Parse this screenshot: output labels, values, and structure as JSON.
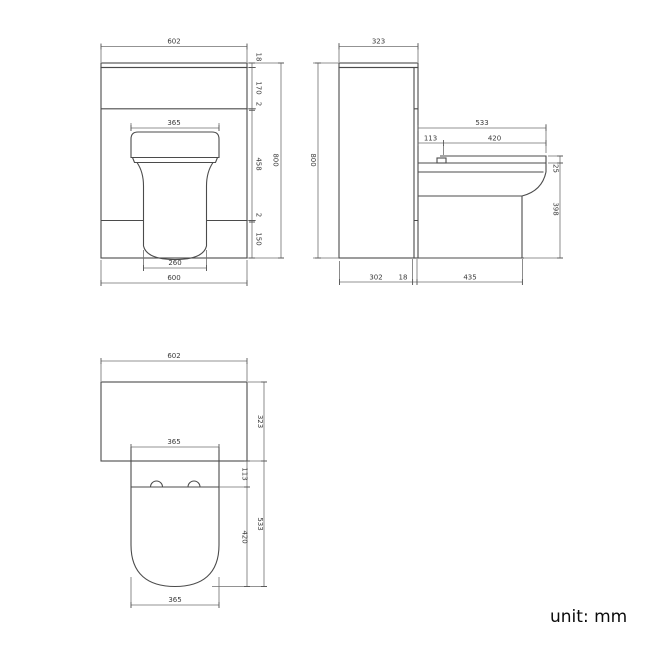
{
  "unit_note": "unit: mm",
  "colors": {
    "line": "#4b4b4b",
    "dimension_line": "#6f6f6f",
    "text": "#3a3a3a"
  },
  "front_view": {
    "worktop_width": "602",
    "worktop_thickness": "18",
    "drawer_height": "170",
    "top_gap": "2",
    "seat_width": "365",
    "middle_height": "458",
    "overall_height": "800",
    "bottom_gap": "2",
    "plinth_height": "150",
    "pan_width": "260",
    "cabinet_width": "600"
  },
  "side_view": {
    "worktop_depth": "323",
    "overall_height": "800",
    "seat_projection": "533",
    "hinge_offset": "113",
    "seat_length": "420",
    "seat_thickness": "25",
    "pan_height": "398",
    "cabinet_depth": "302",
    "panel_thickness": "18",
    "pan_base_projection": "435"
  },
  "plan_view": {
    "worktop_width": "602",
    "cabinet_depth": "323",
    "seat_width": "365",
    "hinge_offset": "113",
    "seat_length": "420",
    "overall_depth": "533",
    "pan_width": "365"
  }
}
